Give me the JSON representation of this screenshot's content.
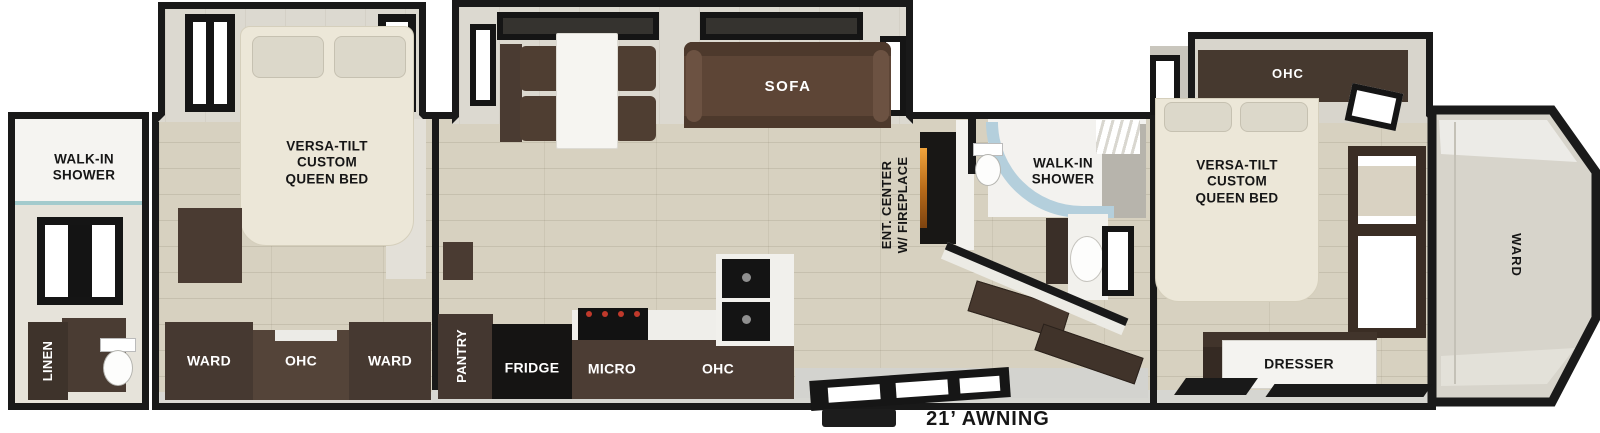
{
  "colors": {
    "wall": "#191919",
    "floor_wood": "#d7d1c0",
    "slide_floor": "#dcd9d0",
    "cabinet_dark": "#46392f",
    "cabinet_medium": "#544439",
    "sofa": "#5d4536",
    "bed": "#ece7d8",
    "shower_glass": "#b4cfdc",
    "fireplace_glow": "#e09a2e",
    "ground": "#d3d3cf"
  },
  "labels": {
    "rear_bath": {
      "shower": "WALK-IN\nSHOWER",
      "linen": "LINEN"
    },
    "bedroom_rear": {
      "bed": "VERSA-TILT\nCUSTOM\nQUEEN BED",
      "ward_left": "WARD",
      "ohc": "OHC",
      "ward_right": "WARD"
    },
    "living": {
      "sofa": "SOFA",
      "ent_center": "ENT. CENTER\nW/ FIREPLACE"
    },
    "kitchen": {
      "pantry": "PANTRY",
      "fridge": "FRIDGE",
      "micro": "MICRO",
      "ohc": "OHC"
    },
    "mid_bath": {
      "shower": "WALK-IN\nSHOWER"
    },
    "bedroom_front": {
      "ohc": "OHC",
      "bed": "VERSA-TILT\nCUSTOM\nQUEEN BED",
      "dresser": "DRESSER"
    },
    "front_cap": {
      "ward": "WARD"
    },
    "exterior": {
      "awning": "21’ AWNING"
    }
  }
}
